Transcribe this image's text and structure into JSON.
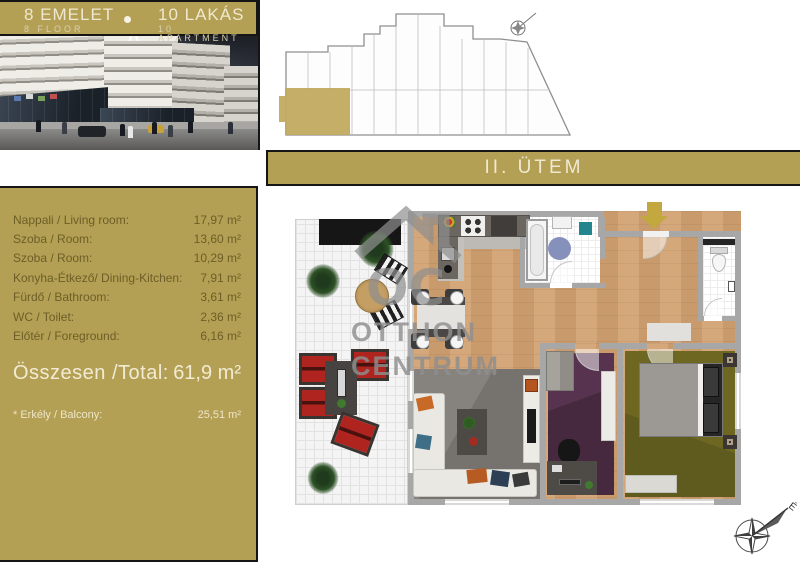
{
  "header": {
    "floor": {
      "hu": "8 EMELET",
      "en": "8 FLOOR"
    },
    "apartments": {
      "hu": "10 LAKÁS",
      "en": "10 APARTMENT"
    },
    "phase": "II. ÜTEM"
  },
  "rooms": [
    {
      "label": "Nappali / Living room:",
      "value": "17,97 m²"
    },
    {
      "label": "Szoba / Room:",
      "value": "13,60 m²"
    },
    {
      "label": "Szoba / Room:",
      "value": "10,29 m²"
    },
    {
      "label": "Konyha-Étkező/ Dining-Kitchen:",
      "value": "7,91 m²"
    },
    {
      "label": "Fürdő / Bathroom:",
      "value": "3,61 m²"
    },
    {
      "label": "WC / Toilet:",
      "value": "2,36 m²"
    },
    {
      "label": "Előtér / Foreground:",
      "value": "6,16 m²"
    }
  ],
  "total": {
    "label": "Összesen /Total:",
    "value": "61,9 m²"
  },
  "balcony_note": {
    "label": "* Erkély / Balcony:",
    "value": "25,51 m²"
  },
  "watermark": {
    "line1": "OTTHON",
    "line2": "CENTRUM",
    "logo_letters": "OC"
  },
  "compass": {
    "north_label": "É"
  },
  "colors": {
    "gold": "#b3a055",
    "gold_unit_highlight": "#c1aa60",
    "cream_text": "#f1ead3",
    "olive_text": "#6d5e27",
    "frame_border": "#151515",
    "wood_floor": "#cf9e70",
    "wall_gray": "#a7a7a7",
    "purple_carpet": "#46293f",
    "olive_carpet": "#6e6722",
    "red_chair": "#b02420",
    "entrance_arrow": "#c2a83e"
  }
}
